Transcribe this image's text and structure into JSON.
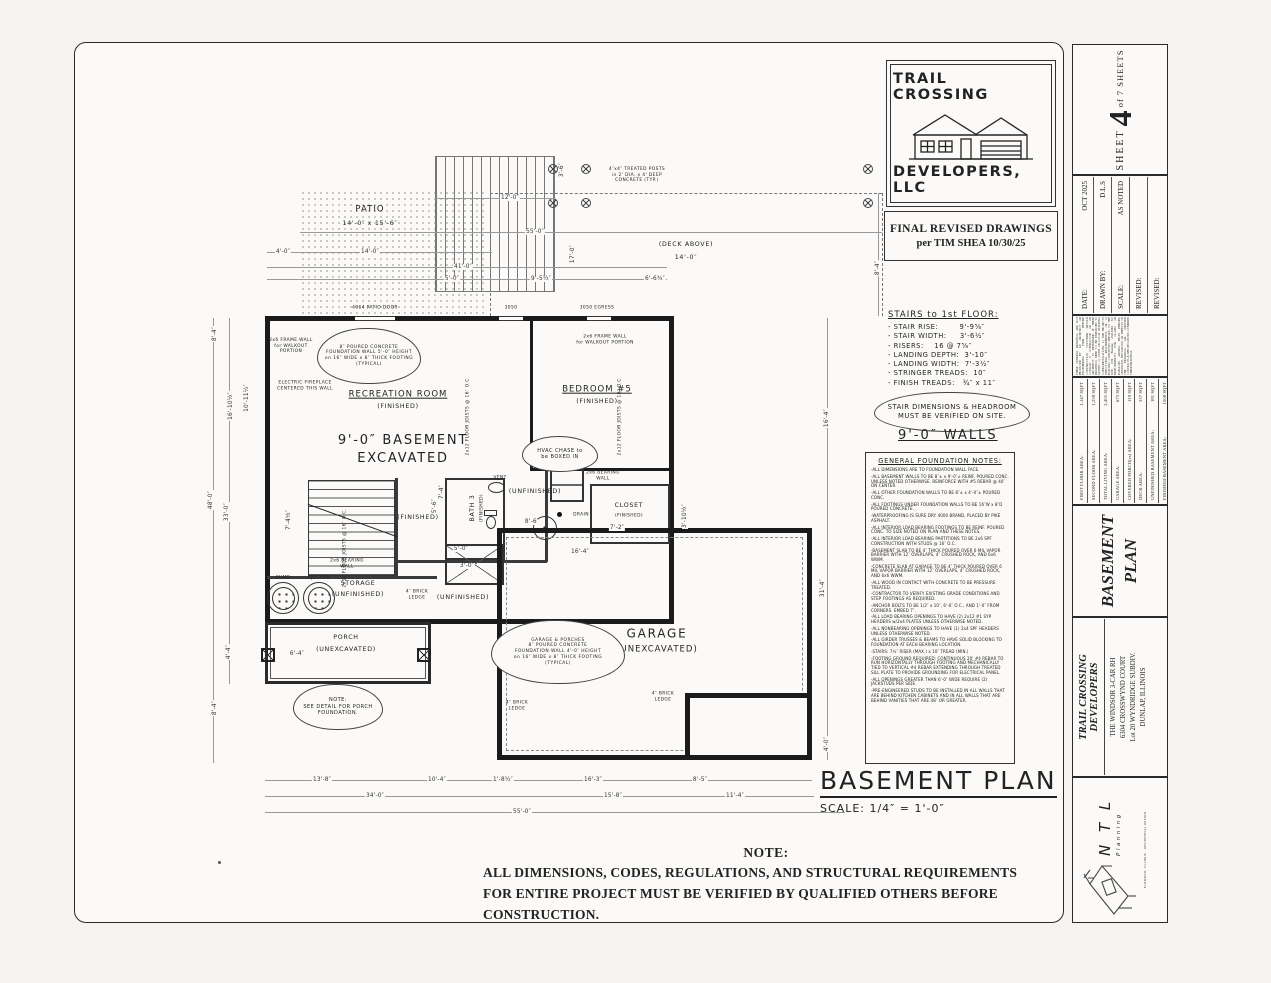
{
  "logo": {
    "line1": "TRAIL CROSSING",
    "line2": "DEVELOPERS, LLC"
  },
  "revision": {
    "line1": "FINAL REVISED DRAWINGS",
    "line2": "per TIM SHEA  10/30/25"
  },
  "stairs": {
    "heading": "STAIRS to 1st FLOOR:",
    "items": [
      "- STAIR RISE:        9'-9⅝″",
      "- STAIR WIDTH:     3'-6½″",
      "- RISERS:    16 @ 7⅝″",
      "- LANDING DEPTH:  3'-10″",
      "- LANDING WIDTH:  7'-3½″",
      "- STRINGER TREADS:  10″",
      "- FINISH TREADS:   ¾″ x 11″"
    ],
    "cloud": "STAIR DIMENSIONS & HEADROOM\nMUST BE VERIFIED ON SITE.",
    "walls": "9'-0″ WALLS"
  },
  "foundation": {
    "heading": "GENERAL FOUNDATION NOTES:",
    "notes": [
      "-ALL DIMENSIONS ARE TO FOUNDATION WALL FACE.",
      "-ALL BASEMENT WALLS TO BE 8″± x 9'-0″± REINF. POURED CONC. UNLESS NOTED OTHERWISE. REINFORCE WITH #5 REBAR @ 40″ ON CENTER.",
      "-ALL OTHER FOUNDATION WALLS TO BE 8″± x 4'-0″± POURED CONC.",
      "-ALL FOOTINGS UNDER FOUNDATION WALLS TO BE 16″W x 8″D POURED CONCRETE.",
      "-WATERPROOFING IS SURE DRY 4000 BRAND, PLACED BY PIKE ASPHALT.",
      "-ALL INTERIOR LOAD BEARING FOOTINGS TO BE REINF. POURED CONC. TO SIZE NOTED ON PLAN AND THESE NOTES.",
      "-ALL INTERIOR LOAD BEARING PARTITIONS TO BE 2x6 SPF CONSTRUCTION WITH STUDS @ 16″ O.C.",
      "-BASEMENT SLAB TO BE 4″ THICK POURED OVER 6 MIL VAPOR BARRIER WITH 12″ OVERLAPS, 4″ CRUSHED ROCK, AND 6x6 WWM.",
      "-CONCRETE SLAB AT GARAGE TO BE 4″ THICK POURED OVER 6 MIL VAPOR BARRIER WITH 12″ OVERLAPS, 4″ CRUSHED ROCK, AND 6x6 WWM.",
      "-ALL WOOD IN CONTACT WITH CONCRETE TO BE PRESSURE TREATED.",
      "-CONTRACTOR TO VERIFY EXISTING GRADE CONDITIONS AND STEP FOOTINGS AS REQUIRED.",
      "-ANCHOR BOLTS TO BE 1/2″ x 10″, 6'-0″ O.C., AND 1'-0″ FROM CORNERS. EMBED 7″.",
      "-ALL LOAD BEARING OPENINGS TO HAVE (2) 2x12 #1 SYP HEADERS w/2x4 PLATES UNLESS OTHERWISE NOTED.",
      "-ALL NONBEARING OPENINGS TO HAVE (1) 2x4 SPF HEADERS UNLESS OTHERWISE NOTED.",
      "-ALL GIRDER TRUSSES & BEAMS TO HAVE SOLID BLOCKING TO FOUNDATION AT EACH BEARING LOCATION.",
      "-STAIRS: 7¾″ RISER (MAX.) x 10″ TREAD (MIN.)",
      "-FOOTING GROUND REQUIRED: CONTINUOUS 20' #4 REBAR TO RUN HORIZONTALLY THROUGH FOOTING AND MECHANICALLY TIED TO VERTICAL #4 REBAR EXTENDING THROUGH TREATED SILL PLATE TO PROVIDE GROUNDING FOR ELECTRICAL PANEL.",
      "-ALL OPENINGS GREATER THAN 6'-0″ WIDE REQUIRE (2) JACKSTUDS PER SIDE.",
      "-PRE-ENGINEERED STUDS TO BE INSTALLED IN ALL WALLS THAT ARE BEHIND KITCHEN CABINETS AND IN ALL WALLS THAT ARE BEHIND VANITIES THAT ARE 48″ OR GREATER."
    ]
  },
  "plan_title": {
    "title": "BASEMENT PLAN",
    "scale": "SCALE: 1/4″ = 1'-0″"
  },
  "note": {
    "heading": "NOTE:",
    "body": "ALL DIMENSIONS, CODES, REGULATIONS, AND STRUCTURAL REQUIREMENTS FOR ENTIRE PROJECT MUST BE VERIFIED BY QUALIFIED OTHERS BEFORE CONSTRUCTION."
  },
  "strip": {
    "sheet_label": "SHEET",
    "sheet_number": "4",
    "sheet_of": "of 7 SHEETS",
    "meta": [
      {
        "label": "DATE:",
        "value": "OCT  2025"
      },
      {
        "label": "DRAWN BY:",
        "value": "D.L.S"
      },
      {
        "label": "SCALE:",
        "value": "AS NOTED"
      },
      {
        "label": "REVISED:",
        "value": ""
      },
      {
        "label": "REVISED:",
        "value": ""
      }
    ],
    "disclaimer": "THESE GENERAL DRAWINGS ARE NOT PRODUCED BY AN ARCHITECT OR ENGINEERING FIRM. BEFORE CONSTRUCTION, CUSTOMER SHOULD CONSULT A CONTRACTOR OR AN ARCHITECT TO DETERMINE IF THESE DRAWINGS NEED TO BE ENHANCED TO SATISFY: 1.) STATE OR LOCAL BUILDING CODES/REGULATIONS, 2.) THE PROJECT'S STRUCTURAL REQUIREMENTS, OR 3.) EXISTING CONDITIONS SPECIFIC TO THE SITE. NTL Planning ASSUMES NO RESPONSIBILITY FOR CLAIMS OR DAMAGES ARISING FROM ERRORS, OMISSIONS, DEVIATIONS OR DEFECTS OF THE DRAWINGS. ALL WRITTEN CONTRACTS & SPECIFICATIONS OVERRIDE THESE DRAWINGS.",
    "areas": [
      {
        "label": "FIRST FLOOR AREA:",
        "value": "1,147 SQFT"
      },
      {
        "label": "SECOND FLOOR AREA:",
        "value": "1,258 SQFT"
      },
      {
        "label": "TOTAL LIVING AREA:",
        "value": "2,405 SQFT"
      },
      {
        "label": "GARAGE AREA:",
        "value": "673 SQFT"
      },
      {
        "label": "COVERED PORCH(es) AREA:",
        "value": "119 SQFT"
      },
      {
        "label": "DECK AREA:",
        "value": "337 SQFT"
      },
      {
        "label": "UNFINISHED BASEMENT AREA:",
        "value": "181 SQFT"
      },
      {
        "label": "FINISHED BASEMENT AREA:",
        "value": "1008 SQFT"
      }
    ],
    "side_title_1": "BASEMENT",
    "side_title_2": "PLAN",
    "developer": "TRAIL CROSSING DEVELOPERS",
    "project": [
      "THE WINDSOR 3-CAR  RH",
      "6304 CROSSWYND COURT",
      "Lot 20 WYNDRIDGE SUBDIV.",
      "DUNLAP, ILLINOIS"
    ],
    "ntl_name": "N T L",
    "ntl_sub": "Planning",
    "ntl_tiny": "ELMWOOD, ILLINOIS  ·  RESIDENTIAL DESIGN"
  },
  "plan": {
    "labels": [
      {
        "t": "PATIO",
        "x": 165,
        "y": 62,
        "c": "r"
      },
      {
        "t": "14'-0″ x 15'-6″",
        "x": 165,
        "y": 76,
        "c": "g"
      },
      {
        "t": "(DECK ABOVE)",
        "x": 481,
        "y": 97,
        "c": "g"
      },
      {
        "t": "14'-0″",
        "x": 481,
        "y": 110,
        "c": "g"
      },
      {
        "t": "4″x4″ TREATED POSTS\nin 2' DIA. x 4' DEEP\nCONCRETE (TYP.)",
        "x": 432,
        "y": 27,
        "c": "t"
      },
      {
        "t": "4064 PATIO DOOR",
        "x": 170,
        "y": 160,
        "c": "t"
      },
      {
        "t": "3050",
        "x": 306,
        "y": 160,
        "c": "t"
      },
      {
        "t": "3050 EGRESS",
        "x": 392,
        "y": 160,
        "c": "t"
      },
      {
        "t": "2x6 FRAME WALL\nfor WALKOUT\nPORTION",
        "x": 86,
        "y": 198,
        "c": "t"
      },
      {
        "t": "2x6 FRAME WALL\nfor WALKOUT PORTION",
        "x": 400,
        "y": 192,
        "c": "t"
      },
      {
        "t": "ELECTRIC FIREPLACE\nCENTERED THIS WALL",
        "x": 100,
        "y": 238,
        "c": "t"
      },
      {
        "t": "RECREATION ROOM",
        "x": 193,
        "y": 247,
        "c": "ru"
      },
      {
        "t": "(FINISHED)",
        "x": 193,
        "y": 259,
        "c": "g"
      },
      {
        "t": "9'-0″ BASEMENT",
        "x": 198,
        "y": 293,
        "c": "b"
      },
      {
        "t": "EXCAVATED",
        "x": 198,
        "y": 311,
        "c": "b"
      },
      {
        "t": "BEDROOM #5",
        "x": 392,
        "y": 242,
        "c": "ru"
      },
      {
        "t": "(FINISHED)",
        "x": 392,
        "y": 254,
        "c": "g"
      },
      {
        "t": "2x12 FLOOR JOISTS @ 16″ O.C.",
        "x": 263,
        "y": 268,
        "r": -90,
        "c": "t"
      },
      {
        "t": "2x12 FLOOR JOISTS @ 16″ O.C.",
        "x": 415,
        "y": 268,
        "r": -90,
        "c": "t"
      },
      {
        "t": "2x12 FLOOR JOISTS @ 16″ O.C.",
        "x": 140,
        "y": 400,
        "r": -90,
        "c": "t"
      },
      {
        "t": "2x6 BEARING\nWALL",
        "x": 398,
        "y": 328,
        "c": "t"
      },
      {
        "t": "2x6 BEARING\nWALL",
        "x": 142,
        "y": 416,
        "c": "t"
      },
      {
        "t": "FURNACE",
        "x": 363,
        "y": 315,
        "c": "t"
      },
      {
        "t": "DRAIN",
        "x": 376,
        "y": 367,
        "c": "t"
      },
      {
        "t": "(UNFINISHED)",
        "x": 330,
        "y": 344,
        "c": "g"
      },
      {
        "t": "CLOSET",
        "x": 424,
        "y": 358,
        "c": "g"
      },
      {
        "t": "(FINISHED)",
        "x": 424,
        "y": 368,
        "c": "t"
      },
      {
        "t": "BATH 3",
        "x": 268,
        "y": 360,
        "r": -90,
        "c": "g"
      },
      {
        "t": "(FINISHED)",
        "x": 277,
        "y": 360,
        "r": -90,
        "c": "t"
      },
      {
        "t": "(FINISHED)",
        "x": 213,
        "y": 370,
        "c": "g"
      },
      {
        "t": "VENT",
        "x": 295,
        "y": 330,
        "c": "t"
      },
      {
        "t": "STORAGE",
        "x": 153,
        "y": 436,
        "c": "g"
      },
      {
        "t": "(UNFINISHED)",
        "x": 153,
        "y": 447,
        "c": "g"
      },
      {
        "t": "SUMP",
        "x": 78,
        "y": 430,
        "c": "t"
      },
      {
        "t": "EJECTOR",
        "x": 114,
        "y": 430,
        "c": "t"
      },
      {
        "t": "(UNFINISHED)",
        "x": 258,
        "y": 450,
        "c": "g"
      },
      {
        "t": "4″ BRICK\nLEDGE",
        "x": 212,
        "y": 447,
        "c": "t"
      },
      {
        "t": "4″ BRICK\nLEDGE",
        "x": 312,
        "y": 558,
        "c": "t"
      },
      {
        "t": "4″ BRICK\nLEDGE",
        "x": 458,
        "y": 549,
        "c": "t"
      },
      {
        "t": "PORCH",
        "x": 141,
        "y": 490,
        "c": "g"
      },
      {
        "t": "(UNEXCAVATED)",
        "x": 141,
        "y": 502,
        "c": "g"
      },
      {
        "t": "GARAGE",
        "x": 452,
        "y": 486,
        "c": "b2"
      },
      {
        "t": "(UNEXCAVATED)",
        "x": 452,
        "y": 502,
        "c": "r"
      }
    ],
    "dims": [
      {
        "t": "55'-0″",
        "x": 330,
        "y": 84
      },
      {
        "t": "4'-0″",
        "x": 78,
        "y": 104
      },
      {
        "t": "14'-0″",
        "x": 165,
        "y": 104
      },
      {
        "t": "41'-0″",
        "x": 258,
        "y": 119
      },
      {
        "t": "5'-0″",
        "x": 247,
        "y": 131
      },
      {
        "t": "9'-5½″",
        "x": 336,
        "y": 131
      },
      {
        "t": "6'-6¾″",
        "x": 450,
        "y": 131
      },
      {
        "t": "12'-0″",
        "x": 305,
        "y": 50
      },
      {
        "t": "3'-6″",
        "x": 357,
        "y": 22,
        "r": -90
      },
      {
        "t": "17'-0″",
        "x": 368,
        "y": 106,
        "r": -90
      },
      {
        "t": "8'-4″",
        "x": 673,
        "y": 120,
        "r": -90
      },
      {
        "t": "8'-4″",
        "x": 10,
        "y": 186,
        "r": -90
      },
      {
        "t": "16'-10½″",
        "x": 26,
        "y": 258,
        "r": -90
      },
      {
        "t": "10'-11¼″",
        "x": 42,
        "y": 250,
        "r": -90
      },
      {
        "t": "48'-0″",
        "x": 6,
        "y": 352,
        "r": -90
      },
      {
        "t": "33'-0″",
        "x": 22,
        "y": 364,
        "r": -90
      },
      {
        "t": "7'-4½″",
        "x": 84,
        "y": 372,
        "r": -90
      },
      {
        "t": "4'-4″",
        "x": 24,
        "y": 504,
        "r": -90
      },
      {
        "t": "8'-4″",
        "x": 10,
        "y": 560,
        "r": -90
      },
      {
        "t": "6'-4″",
        "x": 92,
        "y": 506
      },
      {
        "t": "16'-4″",
        "x": 622,
        "y": 270,
        "r": -90
      },
      {
        "t": "31'-4″",
        "x": 618,
        "y": 440,
        "r": -90
      },
      {
        "t": "4'-0″",
        "x": 622,
        "y": 596,
        "r": -90
      },
      {
        "t": "13'-8″",
        "x": 117,
        "y": 632
      },
      {
        "t": "10'-4″",
        "x": 232,
        "y": 632
      },
      {
        "t": "1'-8½″",
        "x": 298,
        "y": 632
      },
      {
        "t": "16'-3″",
        "x": 388,
        "y": 632
      },
      {
        "t": "8'-5″",
        "x": 495,
        "y": 632
      },
      {
        "t": "34'-0″",
        "x": 170,
        "y": 648
      },
      {
        "t": "15'-8″",
        "x": 408,
        "y": 648
      },
      {
        "t": "11'-4″",
        "x": 530,
        "y": 648
      },
      {
        "t": "55'-0″",
        "x": 317,
        "y": 664
      },
      {
        "t": "16'-4″",
        "x": 375,
        "y": 404
      },
      {
        "t": "8'-6″",
        "x": 327,
        "y": 374
      },
      {
        "t": "7'-4″",
        "x": 237,
        "y": 344,
        "r": -90
      },
      {
        "t": "5'-0″",
        "x": 256,
        "y": 401
      },
      {
        "t": "3'-0″",
        "x": 262,
        "y": 418
      },
      {
        "t": "7'-2″",
        "x": 412,
        "y": 380
      },
      {
        "t": "3'-10½″",
        "x": 480,
        "y": 368,
        "r": -90
      },
      {
        "t": "5'-6″",
        "x": 230,
        "y": 358,
        "r": -90
      }
    ],
    "clouds": [
      {
        "t": "8″ POURED CONCRETE\nFOUNDATION WALL 5'-0″ HEIGHT\non 16″ WIDE x 8″ THICK FOOTING\n(TYPICAL)",
        "x": 112,
        "y": 180,
        "w": 104,
        "h": 56,
        "fs": 4.4
      },
      {
        "t": "HVAC CHASE to\nbe BOXED IN",
        "x": 317,
        "y": 288,
        "w": 76,
        "h": 36,
        "fs": 5
      },
      {
        "t": "GARAGE & PORCHES\n8″ POURED CONCRETE\nFOUNDATION WALL 4'-0″ HEIGHT\non 16″ WIDE x 8″ THICK FOOTING\n(TYPICAL)",
        "x": 286,
        "y": 472,
        "w": 134,
        "h": 64,
        "fs": 4.4
      },
      {
        "t": "NOTE:\nSEE DETAIL FOR PORCH\nFOUNDATION.",
        "x": 88,
        "y": 536,
        "w": 90,
        "h": 46,
        "fs": 5
      }
    ]
  }
}
